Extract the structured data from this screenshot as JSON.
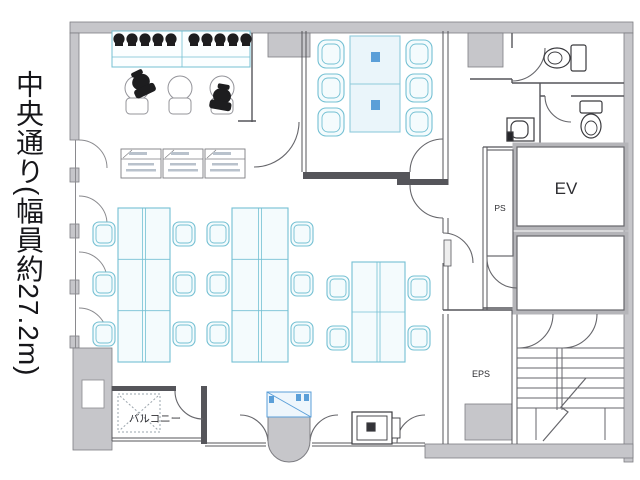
{
  "street_label": "中央通り(幅員約27.2m)",
  "room_labels": {
    "elevator": "EV",
    "pipe_space": "PS",
    "electrical_pipe_space": "EPS",
    "balcony": "バルコニー"
  },
  "colors": {
    "wall_fill": "#c6c6ca",
    "wall_edge": "#7d7d82",
    "line": "#55555a",
    "thin_line": "#8a8a8e",
    "furniture_stroke": "#74c0d3",
    "furniture_fill": "#f4fbfd",
    "accent_blue": "#5b9fd8",
    "dark": "#1d1d1f",
    "text": "#2e2e32"
  },
  "furniture": {
    "counter": {
      "x": 112,
      "y": 31,
      "w": 138,
      "h": 36
    },
    "counter_chairs": {
      "cy": 39,
      "r": 5.6,
      "cx": [
        119,
        132,
        145,
        158,
        171,
        194,
        207,
        220,
        233,
        246
      ]
    },
    "round_tables": {
      "cy": 88,
      "r": 12,
      "cx": [
        137,
        180,
        222
      ]
    },
    "stools": {
      "y": 98,
      "w": 22,
      "h": 16,
      "x": [
        126,
        169,
        211
      ]
    },
    "cabinets": {
      "y": 149,
      "w": 40,
      "h": 29,
      "x": [
        121,
        163,
        205
      ]
    },
    "desk_islands": [
      {
        "x": 118,
        "y": 208,
        "w": 52,
        "h": 154,
        "rows": 3
      },
      {
        "x": 232,
        "y": 208,
        "w": 56,
        "h": 154,
        "rows": 3
      },
      {
        "x": 352,
        "y": 262,
        "w": 53,
        "h": 100,
        "rows": 2
      }
    ],
    "office_chairs": [
      [
        93,
        222
      ],
      [
        93,
        272
      ],
      [
        93,
        322
      ],
      [
        173,
        222
      ],
      [
        173,
        272
      ],
      [
        173,
        322
      ],
      [
        207,
        222
      ],
      [
        207,
        272
      ],
      [
        207,
        322
      ],
      [
        291,
        222
      ],
      [
        291,
        272
      ],
      [
        291,
        322
      ],
      [
        327,
        276
      ],
      [
        327,
        326
      ],
      [
        408,
        276
      ],
      [
        408,
        326
      ]
    ],
    "meeting_table": {
      "x": 350,
      "y": 36,
      "w": 50,
      "h": 96
    },
    "meeting_chairs": [
      [
        318,
        40
      ],
      [
        318,
        74
      ],
      [
        318,
        108
      ],
      [
        406,
        40
      ],
      [
        406,
        74
      ],
      [
        406,
        108
      ]
    ],
    "black_objects": [
      {
        "cx": 141,
        "cy": 82,
        "rot": -25
      },
      {
        "cx": 222,
        "cy": 96,
        "rot": 10
      }
    ]
  }
}
